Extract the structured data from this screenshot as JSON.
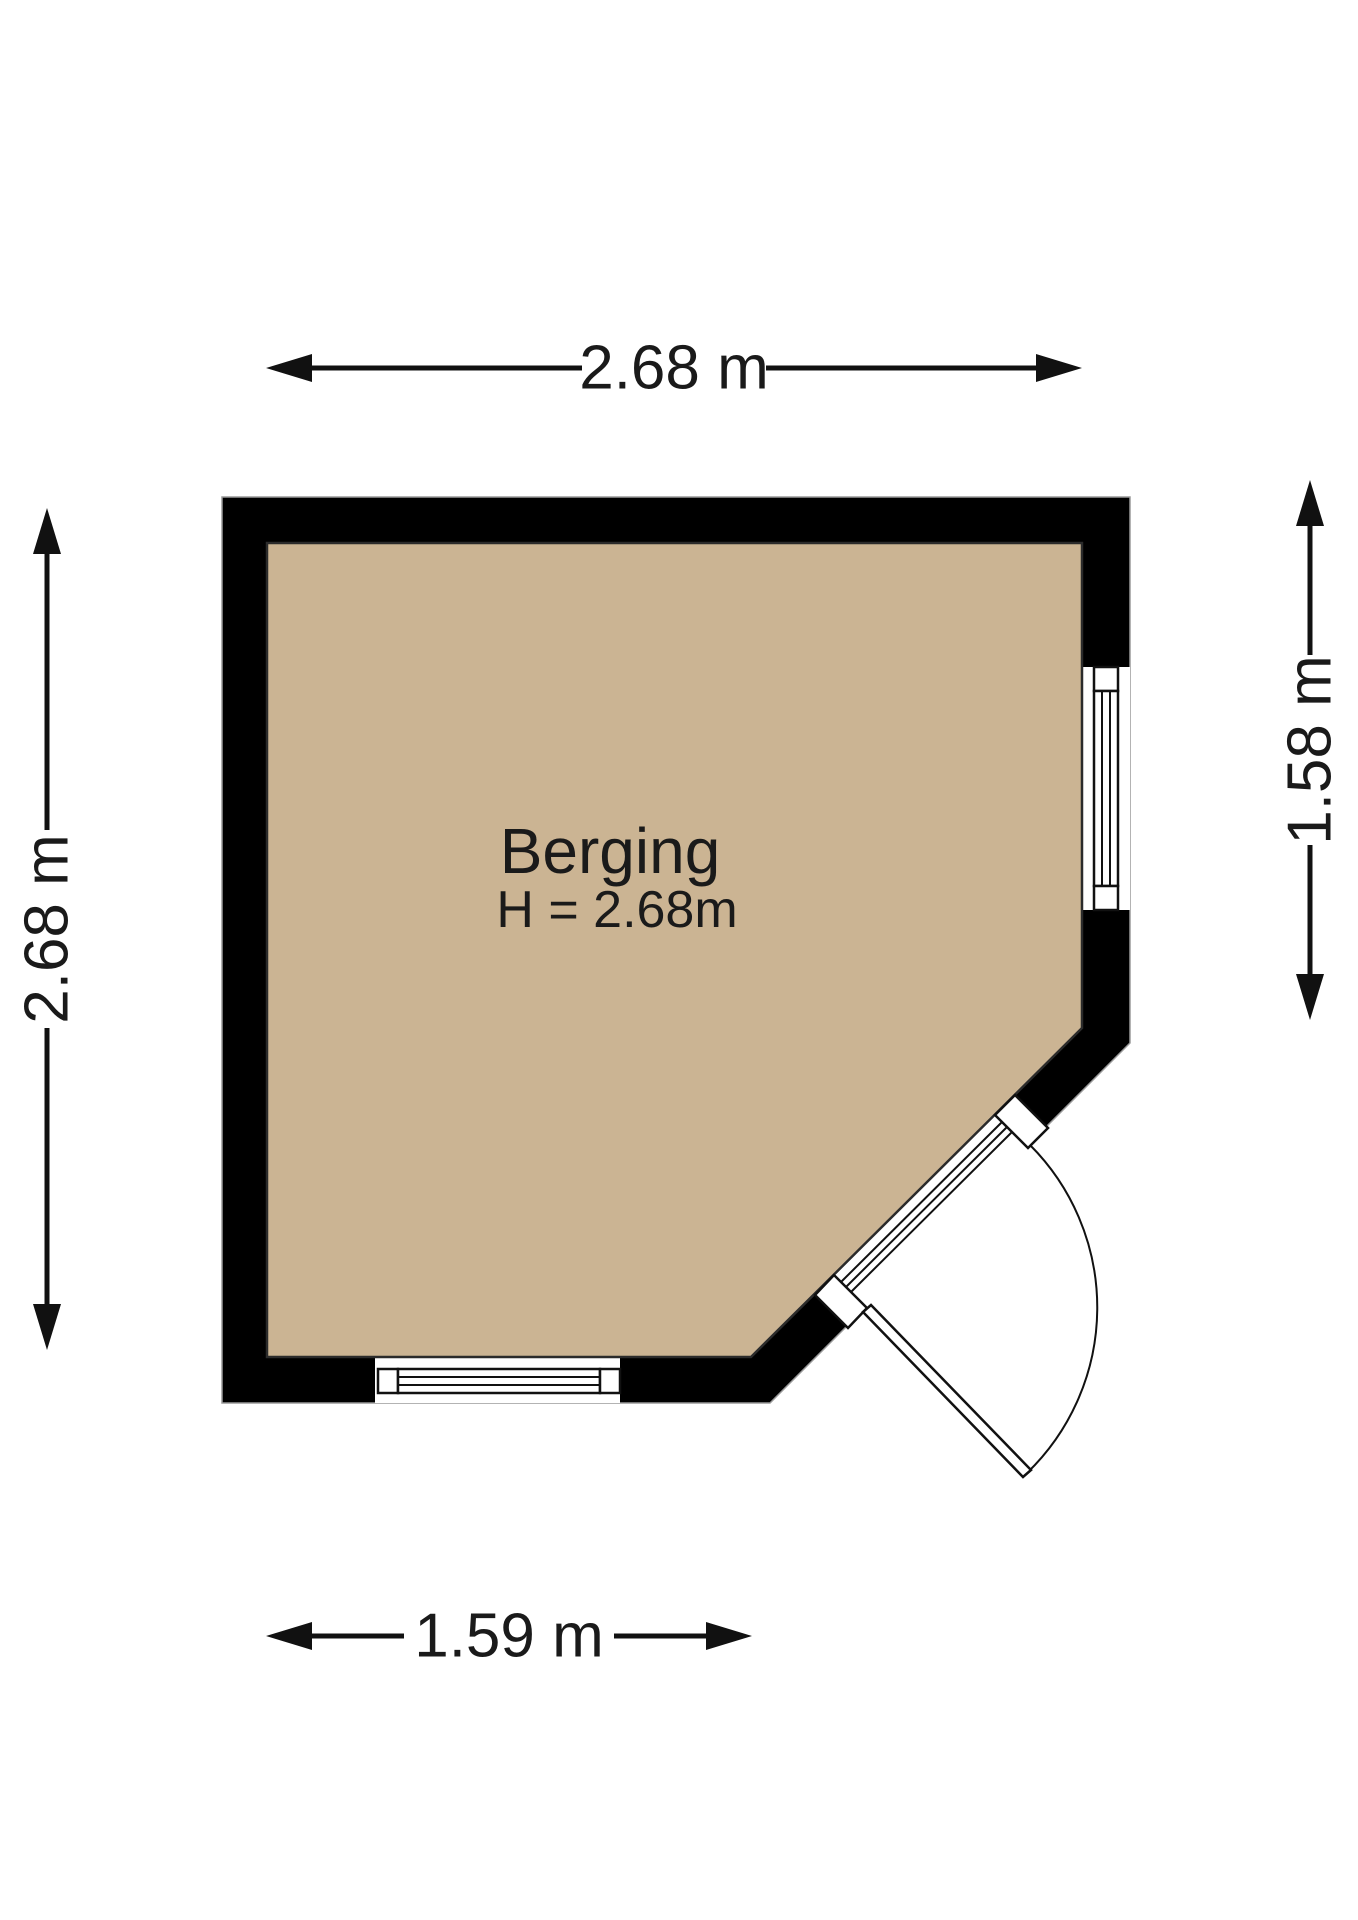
{
  "diagram": {
    "type": "floorplan",
    "room": {
      "label": "Berging",
      "height_label": "H = 2.68m"
    },
    "dimensions": {
      "top": "2.68 m",
      "left": "2.68 m",
      "right": "1.58 m",
      "bottom": "1.59 m"
    },
    "colors": {
      "floor": "#cbb493",
      "wall": "#000000",
      "line": "#111111",
      "background": "#ffffff"
    },
    "features": {
      "window_right": "triple-glazing window",
      "window_bottom": "triple-glazing window",
      "door": "outward swinging door on diagonal wall"
    }
  }
}
